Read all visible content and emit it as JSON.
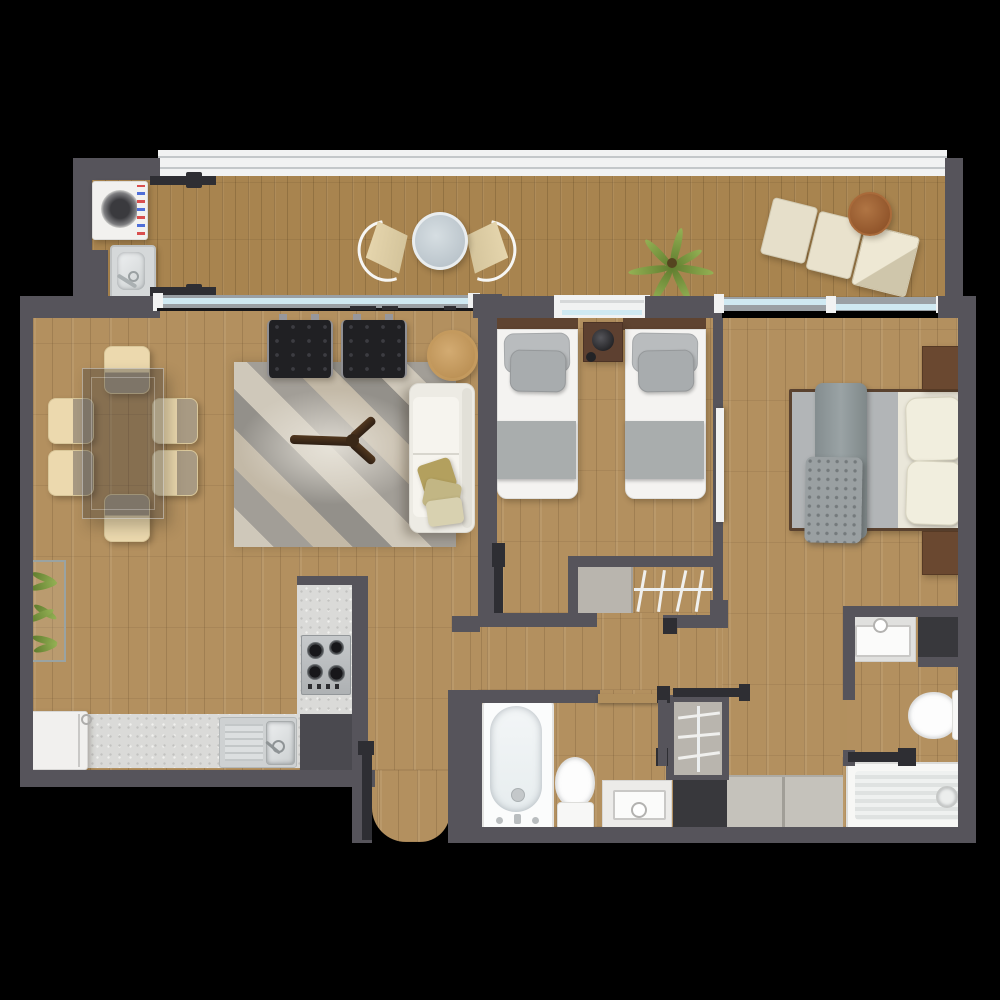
{
  "scene": {
    "type": "apartment-floor-plan",
    "view": "top-down-render",
    "background": "#000000"
  },
  "palette": {
    "wall": "#56545b",
    "walldark": "#2e2e33",
    "wood": "#b3905f",
    "bwood": "#a8844f",
    "glass": "#cfe9f2",
    "frame": "#f1f2f2",
    "counter": "#dadad8",
    "tile": "#c5c2bb",
    "paneldark": "#38383c",
    "doortan": "#b2905e",
    "woodfurn": "#5f4431"
  },
  "rooms": {
    "balcony": {
      "label": "balcony",
      "items": [
        "washing-machine",
        "laundry-sink",
        "butterfly-chair",
        "butterfly-chair",
        "bistro-table",
        "palm-plant",
        "lounge-cushion",
        "lounge-cushion",
        "chaise-lounge",
        "round-side-table"
      ]
    },
    "living_dining": {
      "label": "living-dining-room",
      "items": [
        "dining-table",
        "dining-chair-x6",
        "wall-planter",
        "area-rug",
        "black-armchair",
        "black-armchair",
        "round-side-table",
        "sofa",
        "throw-pillows",
        "propeller-coffee-table"
      ]
    },
    "kitchen": {
      "label": "kitchen",
      "items": [
        "refrigerator",
        "counter-run",
        "kitchen-sink",
        "counter-column",
        "cooktop",
        "dark-cabinet"
      ]
    },
    "bedroom_twin": {
      "label": "twin-bedroom",
      "items": [
        "single-bed",
        "single-bed",
        "nightstand",
        "table-lamp",
        "window",
        "closet-shelf",
        "closet-rail-hangers"
      ]
    },
    "bedroom_master": {
      "label": "master-bedroom",
      "items": [
        "double-bed",
        "pillow",
        "pillow",
        "throw-blanket",
        "folded-blanket",
        "nightstand",
        "nightstand",
        "sliding-glass-door",
        "wardrobe-tiles"
      ]
    },
    "bathroom_main": {
      "label": "main-bathroom",
      "items": [
        "bathtub",
        "toilet",
        "vanity-sink",
        "door",
        "hall-closet-hangers",
        "dark-niche"
      ]
    },
    "bathroom_ensuite": {
      "label": "ensuite-bathroom",
      "items": [
        "vanity-sink",
        "dark-niche",
        "toilet",
        "shower-tray",
        "door"
      ]
    }
  }
}
